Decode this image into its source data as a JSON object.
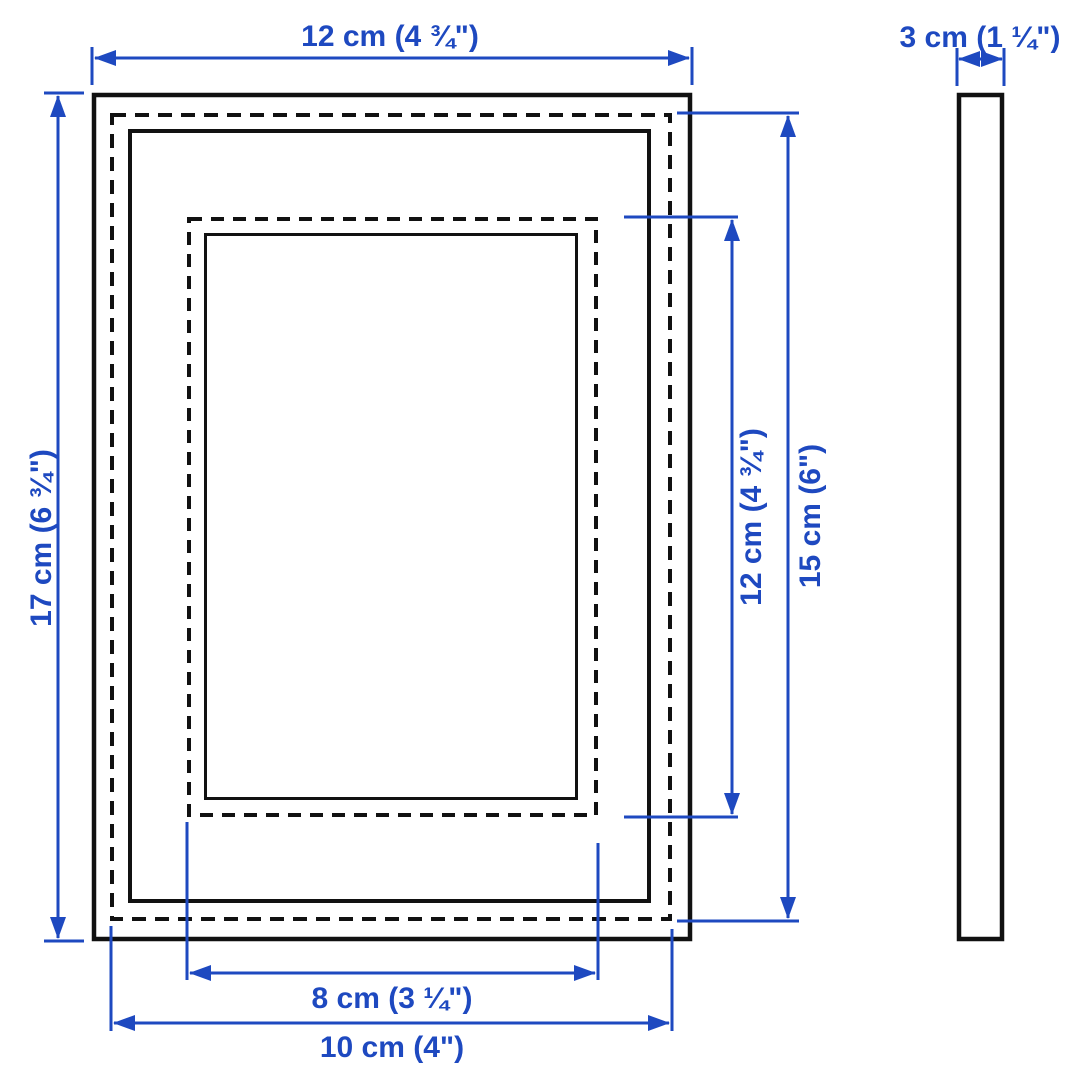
{
  "diagram": {
    "colors": {
      "dimension_blue": "#1e49c0",
      "outline_black": "#111111",
      "background": "#ffffff"
    },
    "dimensions": {
      "frame_width": "12 cm (4 ¾\")",
      "frame_depth": "3 cm (1 ¼\")",
      "frame_height": "17 cm (6 ¾\")",
      "visible_picture_height": "12 cm (4 ¾\")",
      "picture_height": "15 cm (6\")",
      "visible_picture_width": "8 cm (3 ¼\")",
      "picture_width": "10 cm (4\")"
    }
  }
}
